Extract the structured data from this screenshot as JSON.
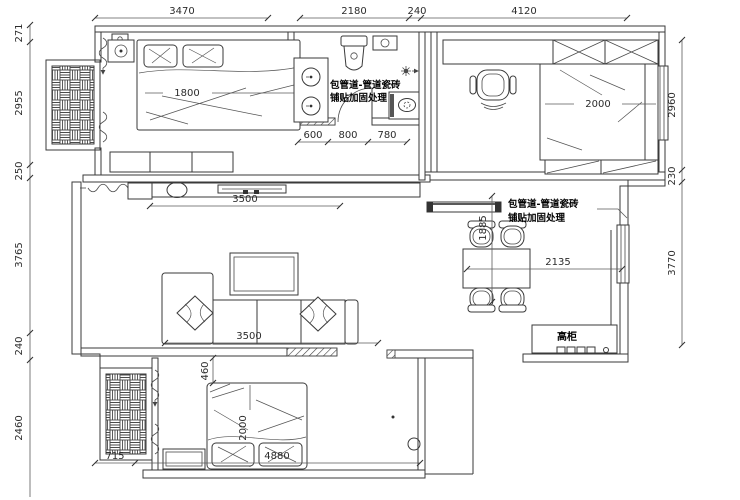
{
  "dimensions": {
    "top": [
      "3470",
      "2180",
      "240",
      "4120"
    ],
    "left": [
      "271",
      "2955",
      "250",
      "3765",
      "240",
      "2460"
    ],
    "right": [
      "2960",
      "230",
      "3770"
    ],
    "bottom": [
      "715",
      "4880"
    ],
    "bathroom": [
      "600",
      "800",
      "780"
    ]
  },
  "rooms": {
    "master_bed_width": "1800",
    "study_bed_width": "2000",
    "tv_wall_width": "3500",
    "sofa_width": "3500",
    "dining_width": "2135",
    "dining_depth": "1885",
    "bed2_clearance": "460",
    "bed2_length": "2000"
  },
  "notes": {
    "pipe_line1": "包管道-管道瓷砖",
    "pipe_line2": "铺贴加固处理",
    "tall_cabinet": "高柜"
  }
}
